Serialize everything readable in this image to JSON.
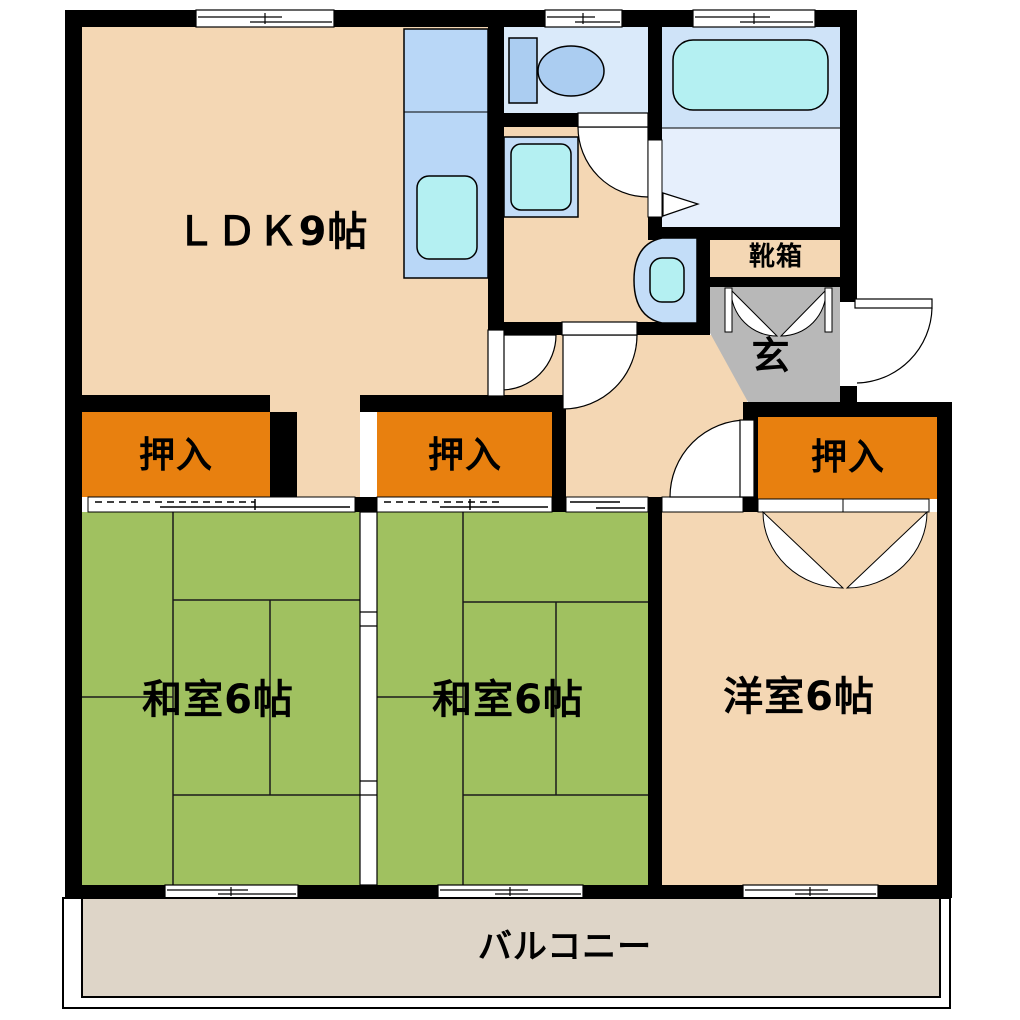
{
  "rooms": {
    "ldk": {
      "label": "ＬＤＫ9帖"
    },
    "washitsu_left": {
      "label": "和室6帖"
    },
    "washitsu_center": {
      "label": "和室6帖"
    },
    "youshitsu": {
      "label": "洋室6帖"
    },
    "balcony": {
      "label": "バルコニー"
    },
    "genkan": {
      "label": "玄"
    },
    "shoe_cabinet": {
      "label": "靴箱"
    },
    "closet_left": {
      "label": "押入"
    },
    "closet_center": {
      "label": "押入"
    },
    "closet_right": {
      "label": "押入"
    }
  },
  "fixtures": {
    "kitchen_sink": "kitchen-sink-icon",
    "toilet": "toilet-icon",
    "bathtub": "bathtub-icon",
    "vanity": "vanity-icon",
    "wash_basin": "wash-basin-icon"
  },
  "colors": {
    "wall": "#000000",
    "room-peach": "#f4d7b4",
    "tatami-green": "#a0c160",
    "closet-orange": "#e8800f",
    "genkan-gray": "#b8b8b8",
    "balcony-floor": "#ded5c8",
    "counter-blue": "#b9d7f7",
    "fixture-blue": "#abcdf1",
    "basin-cyan": "#b4f0f2",
    "toilet-floor": "#daeafa",
    "bath-floor-upper": "#cfe3f8",
    "bath-floor-lower": "#e6effc",
    "vanity-blue": "#c3ddf8"
  }
}
